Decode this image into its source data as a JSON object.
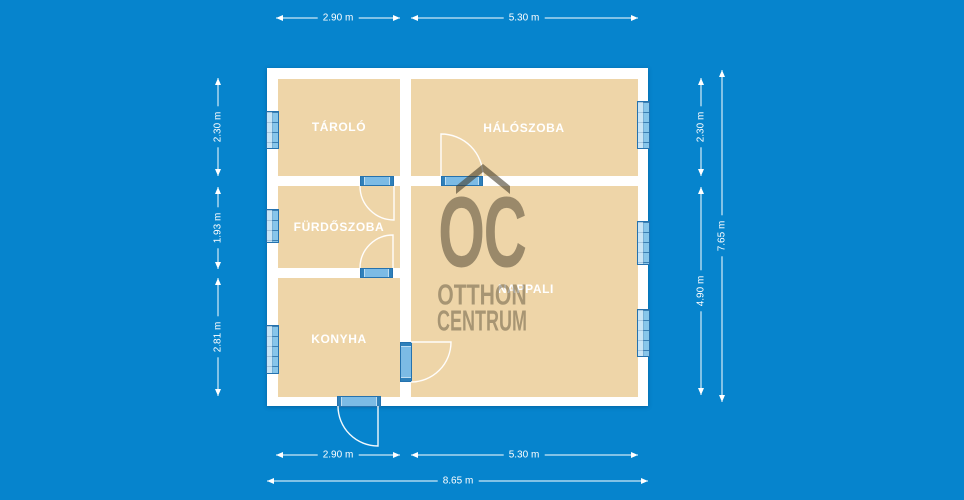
{
  "watermark": {
    "logo": "OC",
    "name_line1": "OTTHON",
    "name_line2": "CENTRUM"
  },
  "rooms": {
    "tarolo": "TÁROLÓ",
    "haloszoba": "HÁLÓSZOBA",
    "furdoszoba": "FÜRDŐSZOBA",
    "konyha": "KONYHA",
    "nappali": "NAPPALI"
  },
  "dimensions": {
    "top": [
      "2.90 m",
      "5.30 m"
    ],
    "bottom": [
      "2.90 m",
      "5.30 m"
    ],
    "bottom_total": "8.65 m",
    "left": [
      "2.30 m",
      "1.93 m",
      "2.81 m"
    ],
    "right": [
      "2.30 m",
      "4.90 m"
    ],
    "right_total": "7.65 m"
  },
  "colors": {
    "background": "#0684cd",
    "floor": "#eed5a8",
    "wall": "#ffffff",
    "window_fill": "#72b6e2",
    "window_frame": "#2572ae",
    "watermark": "#6e6550",
    "dimension_text": "#ffffff",
    "room_label_text": "#ffffff"
  }
}
